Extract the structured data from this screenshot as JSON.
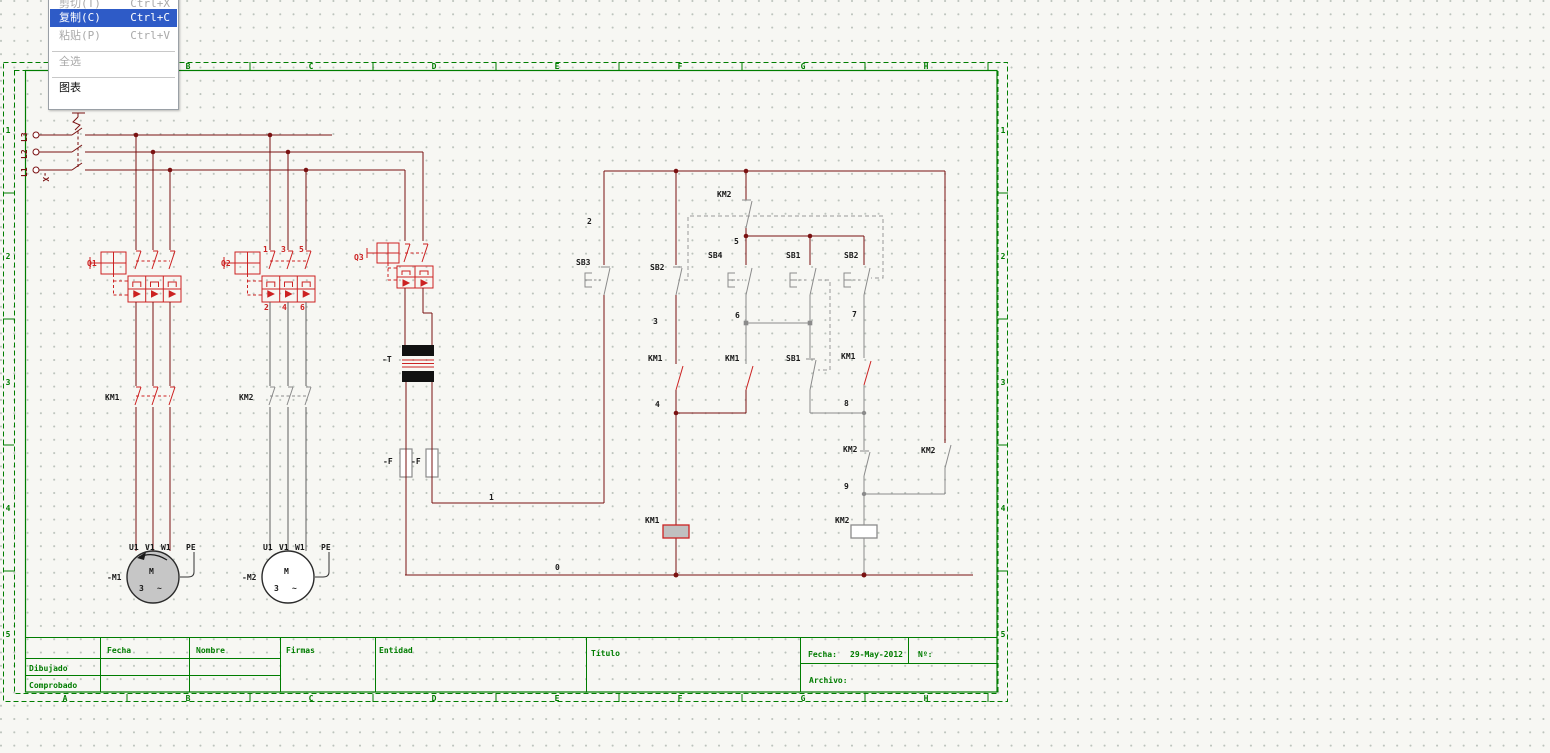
{
  "context_menu": {
    "items": [
      {
        "label": "剪切(T)",
        "shortcut": "Ctrl+X",
        "state": "disabled"
      },
      {
        "label": "复制(C)",
        "shortcut": "Ctrl+C",
        "state": "selected"
      },
      {
        "label": "粘贴(P)",
        "shortcut": "Ctrl+V",
        "state": "disabled"
      },
      {
        "type": "separator"
      },
      {
        "label": "全选",
        "shortcut": "",
        "state": "disabled"
      },
      {
        "type": "separator"
      },
      {
        "label": "图表",
        "shortcut": "",
        "state": "normal"
      }
    ]
  },
  "frame": {
    "zone_letters": [
      "A",
      "B",
      "C",
      "D",
      "E",
      "F",
      "G",
      "H"
    ],
    "row_numbers": [
      "1",
      "2",
      "3",
      "4",
      "5"
    ]
  },
  "title_block": {
    "cells": [
      {
        "t": "Fecha",
        "x": 107,
        "y": 653
      },
      {
        "t": "Nombre",
        "x": 196,
        "y": 653
      },
      {
        "t": "Firmas",
        "x": 286,
        "y": 653
      },
      {
        "t": "Dibujado",
        "x": 29,
        "y": 671
      },
      {
        "t": "Comprobado",
        "x": 29,
        "y": 688
      },
      {
        "t": "Entidad",
        "x": 379,
        "y": 653
      },
      {
        "t": "Título",
        "x": 591,
        "y": 656
      },
      {
        "t": "Fecha:",
        "x": 808,
        "y": 657
      },
      {
        "t": "29-May-2012",
        "x": 850,
        "y": 657
      },
      {
        "t": "Nº:",
        "x": 918,
        "y": 657
      },
      {
        "t": "Archivo:",
        "x": 809,
        "y": 683
      }
    ]
  },
  "schematic": {
    "labels": [
      {
        "t": "L3",
        "x": 27,
        "y": 142,
        "c": "w",
        "r": -90
      },
      {
        "t": "L2",
        "x": 27,
        "y": 159,
        "c": "w",
        "r": -90
      },
      {
        "t": "L1",
        "x": 27,
        "y": 177,
        "c": "w",
        "r": -90
      },
      {
        "t": "-X",
        "x": 43,
        "y": 172,
        "c": "w",
        "r": 90
      },
      {
        "t": "Q1",
        "x": 87,
        "y": 266,
        "c": "r"
      },
      {
        "t": "Q2",
        "x": 221,
        "y": 266,
        "c": "r"
      },
      {
        "t": "Q3",
        "x": 354,
        "y": 260,
        "c": "r"
      },
      {
        "t": "1",
        "x": 263,
        "y": 252,
        "c": "r"
      },
      {
        "t": "3",
        "x": 281,
        "y": 252,
        "c": "r"
      },
      {
        "t": "5",
        "x": 299,
        "y": 252,
        "c": "r"
      },
      {
        "t": "2",
        "x": 264,
        "y": 310,
        "c": "r"
      },
      {
        "t": "4",
        "x": 282,
        "y": 310,
        "c": "r"
      },
      {
        "t": "6",
        "x": 300,
        "y": 310,
        "c": "r"
      },
      {
        "t": "KM1",
        "x": 105,
        "y": 400,
        "c": "k"
      },
      {
        "t": "KM2",
        "x": 239,
        "y": 400,
        "c": "k"
      },
      {
        "t": "-T",
        "x": 382,
        "y": 362,
        "c": "k"
      },
      {
        "t": "-F",
        "x": 383,
        "y": 464,
        "c": "k"
      },
      {
        "t": "-F",
        "x": 411,
        "y": 464,
        "c": "k"
      },
      {
        "t": "U1",
        "x": 129,
        "y": 550,
        "c": "k"
      },
      {
        "t": "V1",
        "x": 145,
        "y": 550,
        "c": "k"
      },
      {
        "t": "W1",
        "x": 161,
        "y": 550,
        "c": "k"
      },
      {
        "t": "PE",
        "x": 186,
        "y": 550,
        "c": "k"
      },
      {
        "t": "U1",
        "x": 263,
        "y": 550,
        "c": "k"
      },
      {
        "t": "V1",
        "x": 279,
        "y": 550,
        "c": "k"
      },
      {
        "t": "W1",
        "x": 295,
        "y": 550,
        "c": "k"
      },
      {
        "t": "PE",
        "x": 321,
        "y": 550,
        "c": "k"
      },
      {
        "t": "-M1",
        "x": 107,
        "y": 580,
        "c": "k"
      },
      {
        "t": "-M2",
        "x": 242,
        "y": 580,
        "c": "k"
      },
      {
        "t": "M",
        "x": 149,
        "y": 574,
        "c": "k"
      },
      {
        "t": "3",
        "x": 139,
        "y": 591,
        "c": "k"
      },
      {
        "t": "~",
        "x": 157,
        "y": 591,
        "c": "k"
      },
      {
        "t": "M",
        "x": 284,
        "y": 574,
        "c": "k"
      },
      {
        "t": "3",
        "x": 274,
        "y": 591,
        "c": "k"
      },
      {
        "t": "~",
        "x": 292,
        "y": 591,
        "c": "k"
      },
      {
        "t": "KM2",
        "x": 717,
        "y": 197,
        "c": "k"
      },
      {
        "t": "2",
        "x": 587,
        "y": 224,
        "c": "k"
      },
      {
        "t": "5",
        "x": 734,
        "y": 244,
        "c": "k"
      },
      {
        "t": "SB3",
        "x": 576,
        "y": 265,
        "c": "k"
      },
      {
        "t": "SB2",
        "x": 650,
        "y": 270,
        "c": "k"
      },
      {
        "t": "SB4",
        "x": 708,
        "y": 258,
        "c": "k"
      },
      {
        "t": "SB1",
        "x": 786,
        "y": 258,
        "c": "k"
      },
      {
        "t": "SB2",
        "x": 844,
        "y": 258,
        "c": "k"
      },
      {
        "t": "3",
        "x": 653,
        "y": 324,
        "c": "k"
      },
      {
        "t": "6",
        "x": 735,
        "y": 318,
        "c": "k"
      },
      {
        "t": "7",
        "x": 852,
        "y": 317,
        "c": "k"
      },
      {
        "t": "KM1",
        "x": 648,
        "y": 361,
        "c": "k"
      },
      {
        "t": "KM1",
        "x": 725,
        "y": 361,
        "c": "k"
      },
      {
        "t": "SB1",
        "x": 786,
        "y": 361,
        "c": "k"
      },
      {
        "t": "KM1",
        "x": 841,
        "y": 359,
        "c": "k"
      },
      {
        "t": "4",
        "x": 655,
        "y": 407,
        "c": "k"
      },
      {
        "t": "8",
        "x": 844,
        "y": 406,
        "c": "k"
      },
      {
        "t": "KM2",
        "x": 843,
        "y": 452,
        "c": "k"
      },
      {
        "t": "KM2",
        "x": 921,
        "y": 453,
        "c": "k"
      },
      {
        "t": "9",
        "x": 844,
        "y": 489,
        "c": "k"
      },
      {
        "t": "KM1",
        "x": 645,
        "y": 523,
        "c": "k"
      },
      {
        "t": "KM2",
        "x": 835,
        "y": 523,
        "c": "k"
      },
      {
        "t": "1",
        "x": 489,
        "y": 500,
        "c": "k"
      },
      {
        "t": "0",
        "x": 555,
        "y": 570,
        "c": "k"
      }
    ]
  },
  "colors": {
    "wire_dark_red": "#7a1212",
    "symbol_red": "#cc2222",
    "symbol_gray": "#8b8b8b",
    "wire_gray": "#5f5f5f",
    "frame_green": "#007d00",
    "menu_highlight": "#2e5bc7",
    "motor_fill": "#c6c6c6",
    "coil_fill": "#c0c0c0"
  }
}
